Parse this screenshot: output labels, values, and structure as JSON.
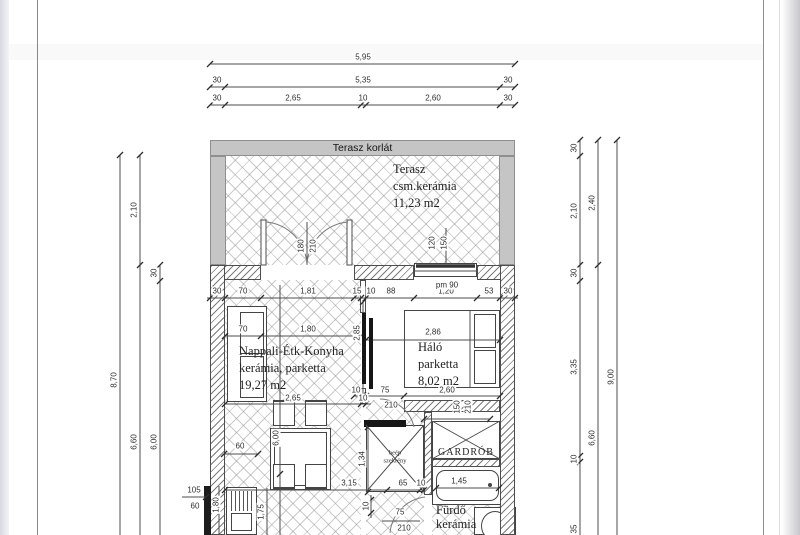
{
  "rooms": {
    "terrace": {
      "railing": "Terasz korlát",
      "name": "Terasz",
      "finish": "csm.kerámia",
      "area": "11,23 m2"
    },
    "living": {
      "name": "Nappali-Étk-Konyha",
      "finish": "kerámia, parketta",
      "area": "19,27 m2"
    },
    "bedroom": {
      "name": "Háló",
      "finish": "parketta",
      "area": "8,02 m2"
    },
    "bathroom": {
      "name": "Fürdő",
      "finish": "kerámia"
    },
    "wardrobe": {
      "name": "GARDRÓB"
    },
    "closet": {
      "line1": "beép",
      "line2": "szekrény"
    }
  },
  "dims": {
    "top": {
      "total": "5,95",
      "row2": [
        "30",
        "5,35",
        "30"
      ],
      "row3": [
        "30",
        "2,65",
        "10",
        "2,60",
        "30"
      ]
    },
    "left": {
      "total": "8,70",
      "terrace_depth": "2,10",
      "below": "6,60",
      "wall": "30",
      "interior": "6,00"
    },
    "right": {
      "col1": [
        "30",
        "2,10",
        "30",
        "3,35",
        "10",
        "35"
      ],
      "col2": [
        "2,40",
        "6,60"
      ],
      "total": "9,00"
    },
    "top_wall": [
      "30",
      "70",
      "1,81",
      "15",
      "10",
      "88",
      "1,20",
      "53",
      "30"
    ],
    "sill": "pm 90",
    "terrace_door": [
      "180",
      "210"
    ],
    "terrace_window": [
      "120",
      "150"
    ],
    "living": {
      "sofa": "70",
      "front": "1,80",
      "height": "2,85",
      "bottom": "2,65",
      "gap": "10",
      "counter": "60",
      "length": "6,00",
      "table": "3,15",
      "k_depth": "1,80",
      "k_len": "1,75",
      "niche_a": "105",
      "niche_b": "60"
    },
    "bedroom": {
      "width": "2,86",
      "door_gap": "10",
      "door": "75",
      "door_h": "210",
      "bottom": "2,60"
    },
    "hall": {
      "closet_h": "1,34",
      "closet_w": "65",
      "closet_gap": "10",
      "pass": "10"
    },
    "wardrobe_door": [
      "150",
      "210"
    ],
    "bath": {
      "tub": "1,45",
      "door": "75",
      "door_h": "210"
    }
  }
}
